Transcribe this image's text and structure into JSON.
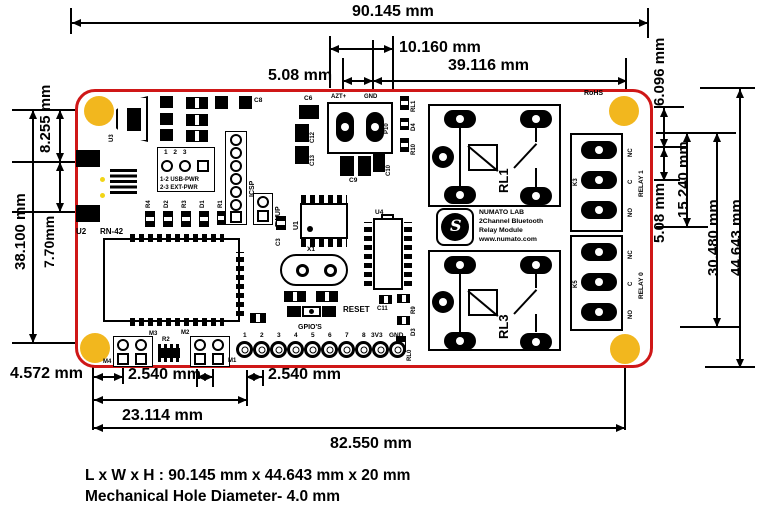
{
  "colors": {
    "board_outline": "#cf1717",
    "mount_hole": "#f2b71e",
    "silk": "#000000",
    "background": "#ffffff"
  },
  "dims": {
    "overall_width": "90.145 mm",
    "d10160": "10.160 mm",
    "d508_top": "5.08 mm",
    "d39116": "39.116 mm",
    "d6096": "6.096 mm",
    "d508_right": "5.08 mm",
    "d15240": "15.240 mm",
    "d30480": "30.480 mm",
    "d44643": "44.643 mm",
    "d8255": "8.255 mm",
    "d770": "7.70mm",
    "d38100": "38.100 mm",
    "d4572": "4.572 mm",
    "d2540_a": "2.540 mm",
    "d2540_b": "2.540 mm",
    "d23114": "23.114 mm",
    "d82550": "82.550 mm"
  },
  "board": {
    "rohs": "RoHS",
    "power_terminal": {
      "pos": "AZT+",
      "neg": "GND",
      "ref": "P10"
    },
    "jumper": {
      "pins": "1    2    3",
      "usb": "1-2 USB-PWR",
      "ext": "2-3 EXT-PWR"
    },
    "icsp": "ICSP",
    "fwup": "FWUP",
    "reset": "RESET",
    "bt_module": {
      "ref": "U2",
      "name": "RN-42"
    },
    "usb_ref": "U3",
    "refs": {
      "c8": "C8",
      "c6": "C6",
      "c12": "C12",
      "c13": "C13",
      "c9": "C9",
      "c10": "C10",
      "rl1s": "RL1",
      "d4": "D4",
      "r10": "R10",
      "r4": "R4",
      "d2": "D2",
      "r3": "R3",
      "d1": "D1",
      "r1": "R1",
      "c3": "C3",
      "u1": "U1",
      "x1": "X1",
      "u4": "U4",
      "c11": "C11",
      "r9": "R9",
      "d3": "D3",
      "rl0": "RL0",
      "r2": "R2",
      "m1": "M1",
      "m2": "M2",
      "m3": "M3",
      "m4": "M4"
    },
    "relay1_ref": "RL1",
    "relay3_ref": "RL3",
    "k3": "K3",
    "k5": "K5",
    "relay1_label": "RELAY 1",
    "relay0_label": "RELAY 0",
    "contacts": [
      "NC",
      "C",
      "NO"
    ],
    "logo": {
      "l1": "NUMATO LAB",
      "l2": "2Channel Bluetooth",
      "l3": "Relay Module",
      "l4": "www.numato.com",
      "mark": "S"
    },
    "gpio": {
      "title": "GPIO'S",
      "pins": [
        "1",
        "2",
        "3",
        "4",
        "5",
        "6",
        "7",
        "8",
        "3V3",
        "GND"
      ]
    }
  },
  "footer": {
    "line1": "L x W x H : 90.145 mm x 44.643 mm x 20 mm",
    "line2": "Mechanical Hole Diameter- 4.0 mm"
  }
}
